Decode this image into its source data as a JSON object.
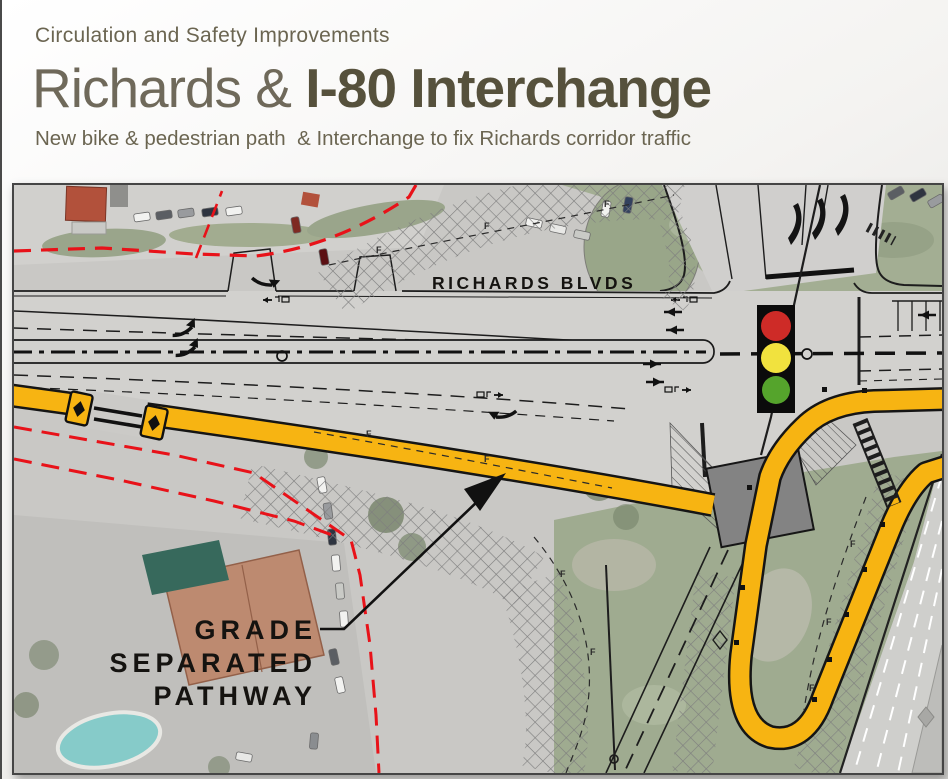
{
  "header": {
    "eyebrow": "Circulation and Safety Improvements",
    "title_regular": "Richards & ",
    "title_bold": "I-80 Interchange",
    "subtitle": "New bike & pedestrian path  & Interchange to fix Richards corridor traffic"
  },
  "map": {
    "road_label": "RICHARDS BLVDS",
    "callout_line1": "GRADE",
    "callout_line2": "SEPARATED",
    "callout_line3": "PATHWAY",
    "fence_letter": "F"
  },
  "icons": {
    "traffic_signal": "traffic-signal-icon",
    "leader_arrow": "leader-arrow-icon"
  },
  "colors": {
    "path_yellow": "#F7B412",
    "signal_red": "#CE2B27",
    "signal_yellow": "#F1E23E",
    "signal_green": "#55A42C",
    "row_red": "#E81219",
    "title_olive": "#56513c"
  }
}
